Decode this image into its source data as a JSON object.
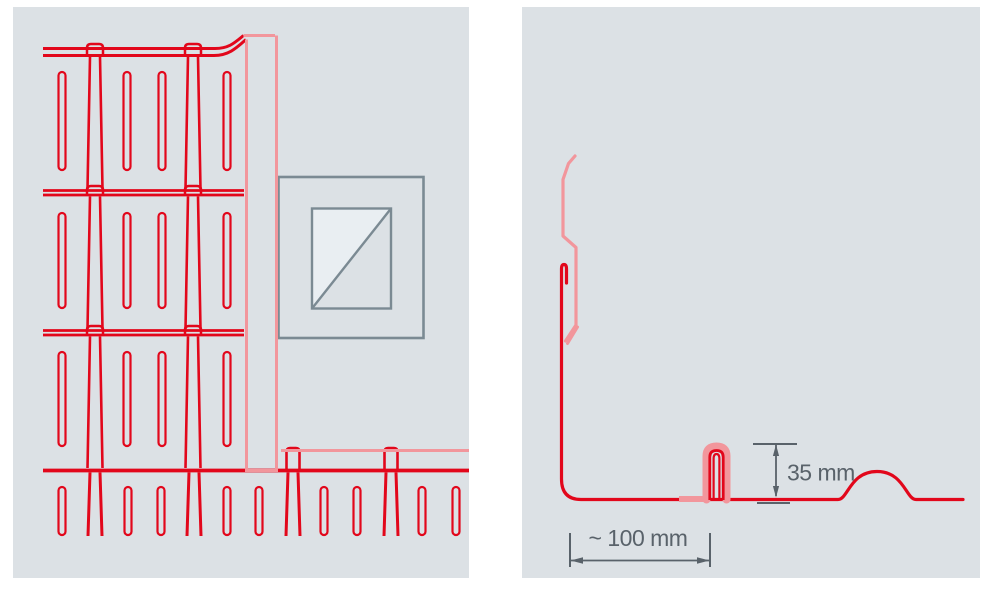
{
  "colors": {
    "page_background": "#ffffff",
    "panel_background": "#dce1e5",
    "line_red": "#e2071b",
    "line_light_red": "#f2969c",
    "dimension_gray": "#59626a",
    "window_frame_gray": "#7b8a93",
    "window_glass": "#e9eef2"
  },
  "left_panel": {
    "description": "elevation of shingle cladding with wall flashing strip and window"
  },
  "right_panel": {
    "description": "section profile of wall flashing with standing seam and sheet rib",
    "dimensions": {
      "seam_height": "35 mm",
      "flashing_width": "~ 100 mm"
    }
  }
}
